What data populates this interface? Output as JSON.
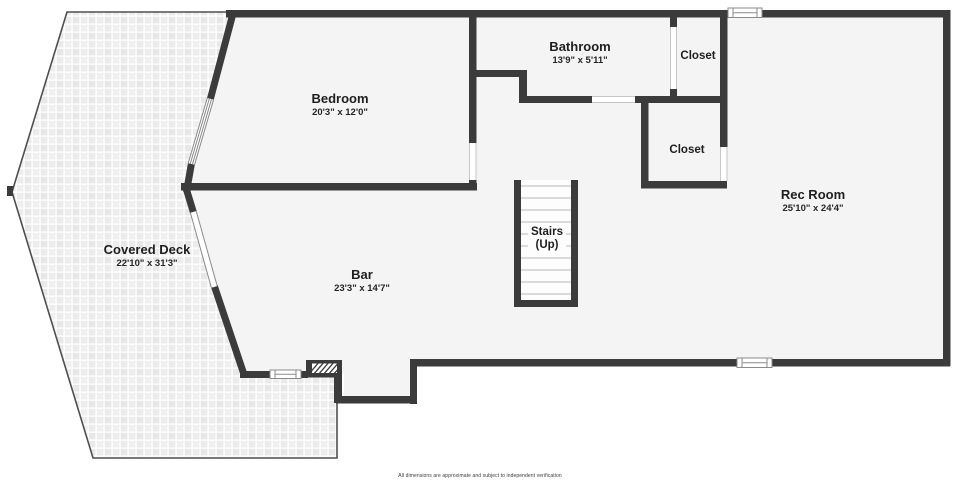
{
  "labels": {
    "bedroom": {
      "name": "Bedroom",
      "dims": "20'3\" x 12'0\""
    },
    "bathroom": {
      "name": "Bathroom",
      "dims": "13'9\" x 5'11\""
    },
    "closet_top": {
      "name": "Closet"
    },
    "closet_mid": {
      "name": "Closet"
    },
    "rec_room": {
      "name": "Rec Room",
      "dims": "25'10\" x 24'4\""
    },
    "bar": {
      "name": "Bar",
      "dims": "23'3\" x 14'7\""
    },
    "covered_deck": {
      "name": "Covered Deck",
      "dims": "22'10\" x 31'3\""
    },
    "stairs": {
      "name": "Stairs",
      "sub": "(Up)"
    }
  },
  "footer": "All dimensions are approximate and subject to independent verification",
  "colors": {
    "wall": "#3b3b3b",
    "floor": "#f4f4f4",
    "outline": "#4f4f4f"
  }
}
